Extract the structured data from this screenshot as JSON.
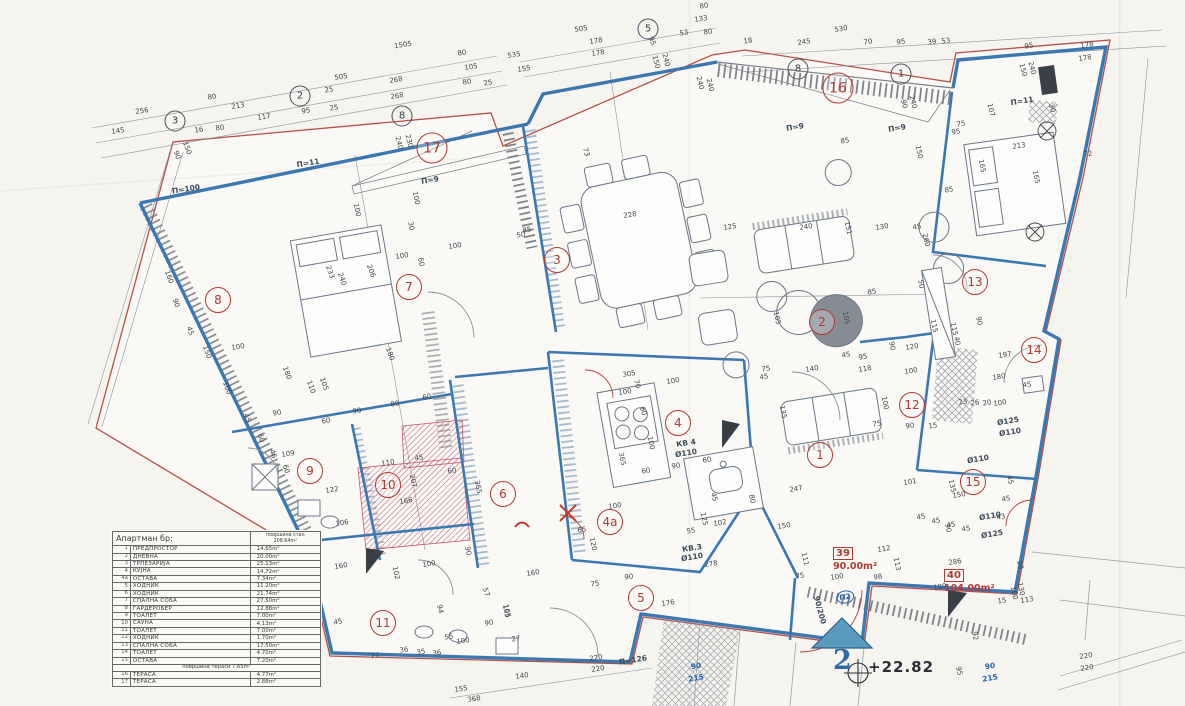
{
  "legend": {
    "title": "Апартман бр:",
    "area_header_label": "површина стан",
    "area_header_value": "208.64m²",
    "rows": [
      [
        "1",
        "ПРЕДПРОСТОР",
        "14.65m²"
      ],
      [
        "2",
        "ДНЕВНА",
        "20.00m²"
      ],
      [
        "3",
        "ТРПЕЗАРИЈА",
        "25.13m²"
      ],
      [
        "4",
        "КУЈНА",
        "14.72m²"
      ],
      [
        "4a",
        "ОСТАВА",
        "7.34m²"
      ],
      [
        "5",
        "ХОДНИК",
        "11.20m²"
      ],
      [
        "6",
        "ХОДНИК",
        "21.74m²"
      ],
      [
        "7",
        "СПАЛНА СОБА",
        "27.50m²"
      ],
      [
        "8",
        "ГАРДЕРОБЕР",
        "12.88m²"
      ],
      [
        "9",
        "ТОАЛЕТ",
        "7.00m²"
      ],
      [
        "10",
        "САУНА",
        "4.13m²"
      ],
      [
        "11",
        "ТОАЛЕТ",
        "7.00m²"
      ],
      [
        "12",
        "ХОДНИК",
        "1.70m²"
      ],
      [
        "13",
        "СПАЛНА СОБА",
        "17.50m²"
      ],
      [
        "14",
        "ТОАЛЕТ",
        "4.70m²"
      ],
      [
        "15",
        "ОСТАВА",
        "7.20m²"
      ]
    ],
    "terrace_header_label": "површина тераси",
    "terrace_header_value": "7.65m²",
    "terrace_rows": [
      [
        "16",
        "ТЕРАСА",
        "4.77m²"
      ],
      [
        "17",
        "ТЕРАСА",
        "2.88m²"
      ]
    ]
  },
  "apartments": [
    {
      "code": "39",
      "area": "90.00m²",
      "x": 833,
      "y": 541
    },
    {
      "code": "40",
      "area": "104.00m²",
      "x": 944,
      "y": 563
    }
  ],
  "elevation": {
    "value": "+22.82",
    "floor_number": "2"
  },
  "plan": {
    "rooms": [
      [
        "1",
        820,
        455
      ],
      [
        "2",
        822,
        322
      ],
      [
        "3",
        557,
        260
      ],
      [
        "4",
        678,
        423
      ],
      [
        "4a",
        610,
        522
      ],
      [
        "5",
        641,
        598
      ],
      [
        "6",
        503,
        494
      ],
      [
        "7",
        409,
        287
      ],
      [
        "8",
        218,
        300
      ],
      [
        "9",
        310,
        471
      ],
      [
        "10",
        388,
        485
      ],
      [
        "11",
        383,
        623
      ],
      [
        "12",
        912,
        405
      ],
      [
        "13",
        975,
        282
      ],
      [
        "14",
        1034,
        350
      ],
      [
        "15",
        973,
        482
      ],
      [
        "16",
        838,
        88
      ],
      [
        "17",
        432,
        148
      ]
    ],
    "axis_markers": [
      [
        "3",
        175,
        121
      ],
      [
        "2",
        300,
        96
      ],
      [
        "8",
        402,
        116
      ],
      [
        "5",
        648,
        29
      ],
      [
        "8",
        798,
        69
      ],
      [
        "1",
        901,
        74
      ]
    ],
    "labels": [
      [
        "П=11",
        308,
        163
      ],
      [
        "П=9",
        430,
        180
      ],
      [
        "П=9",
        795,
        127
      ],
      [
        "П=9",
        897,
        128
      ],
      [
        "П=11",
        1022,
        101
      ],
      [
        "П=100",
        186,
        189
      ],
      [
        "П=126",
        633,
        660
      ],
      [
        "КВ 4",
        686,
        443
      ],
      [
        "Ø110",
        686,
        453
      ],
      [
        "КВ.3",
        692,
        548
      ],
      [
        "Ø110",
        692,
        557
      ],
      [
        "Ø125",
        1008,
        421
      ],
      [
        "Ø110",
        1010,
        432
      ],
      [
        "Ø110",
        990,
        516
      ],
      [
        "Ø125",
        992,
        534
      ],
      [
        "Ø110",
        978,
        459
      ],
      [
        "90",
        696,
        666,
        "b"
      ],
      [
        "215",
        696,
        678,
        "b"
      ],
      [
        "90",
        990,
        666,
        "b"
      ],
      [
        "215",
        990,
        678,
        "b"
      ],
      [
        "90/200",
        820,
        610,
        "",
        75
      ],
      [
        "П2",
        845,
        597,
        "b ring"
      ]
    ],
    "dims": [
      [
        "1505",
        403,
        45
      ],
      [
        "80",
        462,
        53
      ],
      [
        "105",
        471,
        67
      ],
      [
        "535",
        514,
        55
      ],
      [
        "155",
        524,
        69
      ],
      [
        "505",
        341,
        77
      ],
      [
        "268",
        396,
        80
      ],
      [
        "80",
        467,
        82
      ],
      [
        "25",
        488,
        83
      ],
      [
        "25",
        329,
        90
      ],
      [
        "268",
        397,
        96
      ],
      [
        "80",
        212,
        97
      ],
      [
        "213",
        238,
        106
      ],
      [
        "95",
        306,
        111
      ],
      [
        "25",
        334,
        108
      ],
      [
        "117",
        264,
        117
      ],
      [
        "256",
        142,
        111
      ],
      [
        "145",
        118,
        131
      ],
      [
        "16",
        199,
        130
      ],
      [
        "80",
        220,
        128
      ],
      [
        "90",
        177,
        155,
        70
      ],
      [
        "150",
        187,
        148,
        70
      ],
      [
        "80",
        704,
        6
      ],
      [
        "133",
        701,
        19
      ],
      [
        "505",
        581,
        29
      ],
      [
        "178",
        596,
        41
      ],
      [
        "178",
        598,
        53
      ],
      [
        "95",
        652,
        41,
        70
      ],
      [
        "53",
        684,
        33
      ],
      [
        "80",
        708,
        32
      ],
      [
        "530",
        841,
        29
      ],
      [
        "18",
        748,
        41
      ],
      [
        "245",
        804,
        42
      ],
      [
        "70",
        868,
        42
      ],
      [
        "95",
        901,
        42
      ],
      [
        "39",
        932,
        42
      ],
      [
        "150",
        656,
        62,
        75
      ],
      [
        "240",
        666,
        60,
        75
      ],
      [
        "240",
        700,
        83,
        75
      ],
      [
        "240",
        710,
        85,
        75
      ],
      [
        "90",
        904,
        104,
        75
      ],
      [
        "240",
        913,
        102,
        75
      ],
      [
        "53",
        946,
        41
      ],
      [
        "95",
        1029,
        46
      ],
      [
        "178",
        1087,
        45
      ],
      [
        "178",
        1085,
        58
      ],
      [
        "150",
        1023,
        70,
        75
      ],
      [
        "240",
        1032,
        68,
        75
      ],
      [
        "107",
        991,
        110,
        75
      ],
      [
        "30",
        1052,
        108,
        75
      ],
      [
        "75",
        961,
        124
      ],
      [
        "95",
        956,
        132
      ],
      [
        "213",
        1019,
        146
      ],
      [
        "72",
        1088,
        154
      ],
      [
        "165",
        982,
        166,
        78
      ],
      [
        "165",
        1036,
        177,
        78
      ],
      [
        "85",
        949,
        190
      ],
      [
        "73",
        586,
        152,
        75
      ],
      [
        "85",
        527,
        230
      ],
      [
        "228",
        630,
        215
      ],
      [
        "125",
        730,
        227
      ],
      [
        "85",
        845,
        141
      ],
      [
        "240",
        806,
        227
      ],
      [
        "151",
        848,
        228,
        78
      ],
      [
        "130",
        882,
        227
      ],
      [
        "45",
        917,
        227
      ],
      [
        "150",
        919,
        152,
        78
      ],
      [
        "260",
        926,
        240,
        78
      ],
      [
        "50",
        921,
        284,
        78
      ],
      [
        "85",
        872,
        292
      ],
      [
        "105",
        777,
        318,
        78
      ],
      [
        "105",
        846,
        318,
        78
      ],
      [
        "240",
        399,
        143,
        75
      ],
      [
        "230",
        409,
        141,
        75
      ],
      [
        "100",
        416,
        198,
        78
      ],
      [
        "100",
        357,
        210,
        78
      ],
      [
        "30",
        411,
        226,
        78
      ],
      [
        "100",
        402,
        256
      ],
      [
        "100",
        455,
        246
      ],
      [
        "60",
        421,
        262,
        78
      ],
      [
        "50",
        521,
        235
      ],
      [
        "233",
        330,
        272,
        70
      ],
      [
        "240",
        342,
        279,
        70
      ],
      [
        "206",
        371,
        271,
        70
      ],
      [
        "160",
        169,
        277,
        70
      ],
      [
        "90",
        176,
        303,
        70
      ],
      [
        "45",
        190,
        331,
        70
      ],
      [
        "150",
        207,
        352,
        70
      ],
      [
        "100",
        227,
        388,
        70
      ],
      [
        "45",
        247,
        418,
        70
      ],
      [
        "60",
        261,
        438,
        70
      ],
      [
        "46",
        273,
        454,
        70
      ],
      [
        "60",
        286,
        469,
        70
      ],
      [
        "100",
        238,
        347
      ],
      [
        "109",
        288,
        454
      ],
      [
        "122",
        332,
        490
      ],
      [
        "110",
        388,
        463
      ],
      [
        "45",
        419,
        458
      ],
      [
        "207",
        413,
        481,
        78
      ],
      [
        "60",
        452,
        471
      ],
      [
        "166",
        406,
        501
      ],
      [
        "106",
        342,
        523
      ],
      [
        "365",
        478,
        487,
        78
      ],
      [
        "90",
        468,
        551,
        78
      ],
      [
        "160",
        341,
        566
      ],
      [
        "100",
        429,
        564
      ],
      [
        "102",
        396,
        573,
        78
      ],
      [
        "45",
        338,
        622
      ],
      [
        "94",
        440,
        609,
        78
      ],
      [
        "55",
        449,
        637
      ],
      [
        "100",
        463,
        641
      ],
      [
        "36",
        404,
        650
      ],
      [
        "35",
        421,
        652
      ],
      [
        "36",
        437,
        653
      ],
      [
        "77",
        375,
        656
      ],
      [
        "165",
        506,
        611,
        78
      ],
      [
        "90",
        489,
        623
      ],
      [
        "27",
        516,
        639
      ],
      [
        "57",
        486,
        592,
        70
      ],
      [
        "180",
        287,
        373,
        70
      ],
      [
        "110",
        311,
        387,
        70
      ],
      [
        "105",
        324,
        384,
        70
      ],
      [
        "180",
        390,
        354,
        70
      ],
      [
        "90",
        277,
        413
      ],
      [
        "60",
        326,
        421
      ],
      [
        "90",
        357,
        411
      ],
      [
        "80",
        395,
        404
      ],
      [
        "60",
        427,
        397
      ],
      [
        "160",
        533,
        573
      ],
      [
        "75",
        595,
        584
      ],
      [
        "90",
        629,
        577
      ],
      [
        "105",
        507,
        611,
        78
      ],
      [
        "176",
        668,
        603
      ],
      [
        "368",
        474,
        699
      ],
      [
        "155",
        461,
        689
      ],
      [
        "140",
        522,
        676
      ],
      [
        "220",
        596,
        658
      ],
      [
        "220",
        598,
        669
      ],
      [
        "305",
        629,
        374
      ],
      [
        "100",
        673,
        381
      ],
      [
        "70",
        637,
        384,
        75
      ],
      [
        "100",
        625,
        392
      ],
      [
        "60",
        643,
        411,
        75
      ],
      [
        "365",
        622,
        459,
        78
      ],
      [
        "100",
        651,
        443,
        78
      ],
      [
        "60",
        646,
        471
      ],
      [
        "90",
        676,
        466
      ],
      [
        "60",
        707,
        460
      ],
      [
        "100",
        615,
        506
      ],
      [
        "65",
        582,
        530
      ],
      [
        "120",
        593,
        544,
        78
      ],
      [
        "125",
        704,
        519,
        78
      ],
      [
        "102",
        720,
        523
      ],
      [
        "55",
        691,
        531
      ],
      [
        "45",
        714,
        497,
        75
      ],
      [
        "135",
        783,
        412,
        78
      ],
      [
        "45",
        764,
        377
      ],
      [
        "75",
        766,
        369
      ],
      [
        "150",
        784,
        526
      ],
      [
        "80",
        752,
        499,
        78
      ],
      [
        "278",
        711,
        564
      ],
      [
        "140",
        812,
        369
      ],
      [
        "118",
        865,
        369
      ],
      [
        "120",
        912,
        347
      ],
      [
        "90",
        892,
        346,
        78
      ],
      [
        "100",
        911,
        371
      ],
      [
        "115",
        934,
        326,
        78
      ],
      [
        "115",
        954,
        329,
        78
      ],
      [
        "95",
        863,
        357
      ],
      [
        "45",
        846,
        355
      ],
      [
        "100",
        885,
        403,
        78
      ],
      [
        "90",
        910,
        426
      ],
      [
        "75",
        877,
        424
      ],
      [
        "15",
        933,
        426
      ],
      [
        "247",
        796,
        489
      ],
      [
        "111",
        805,
        559,
        78
      ],
      [
        "113",
        897,
        564,
        78
      ],
      [
        "75",
        800,
        576
      ],
      [
        "100",
        837,
        577
      ],
      [
        "98",
        878,
        577
      ],
      [
        "112",
        884,
        549
      ],
      [
        "180",
        999,
        377
      ],
      [
        "197",
        1005,
        355
      ],
      [
        "45",
        1027,
        385
      ],
      [
        "90",
        979,
        321,
        78
      ],
      [
        "40",
        957,
        341,
        78
      ],
      [
        "23",
        963,
        402
      ],
      [
        "26",
        975,
        403
      ],
      [
        "20",
        987,
        403
      ],
      [
        "100",
        1000,
        403
      ],
      [
        "101",
        910,
        482
      ],
      [
        "135",
        952,
        486,
        78
      ],
      [
        "150",
        959,
        495
      ],
      [
        "45",
        1010,
        480,
        78
      ],
      [
        "45",
        1006,
        499
      ],
      [
        "43",
        1001,
        517
      ],
      [
        "45",
        921,
        517
      ],
      [
        "45",
        936,
        521
      ],
      [
        "45",
        951,
        525
      ],
      [
        "45",
        966,
        529
      ],
      [
        "90",
        948,
        528,
        78
      ],
      [
        "286",
        955,
        562
      ],
      [
        "189",
        940,
        587
      ],
      [
        "113",
        1027,
        600
      ],
      [
        "100",
        1014,
        593,
        78
      ],
      [
        "130",
        1021,
        589,
        78
      ],
      [
        "15",
        1002,
        601
      ],
      [
        "28",
        1020,
        565,
        78
      ],
      [
        "92",
        975,
        636,
        78
      ],
      [
        "95",
        959,
        671,
        78
      ],
      [
        "220",
        1086,
        656
      ],
      [
        "220",
        1087,
        668
      ]
    ]
  }
}
